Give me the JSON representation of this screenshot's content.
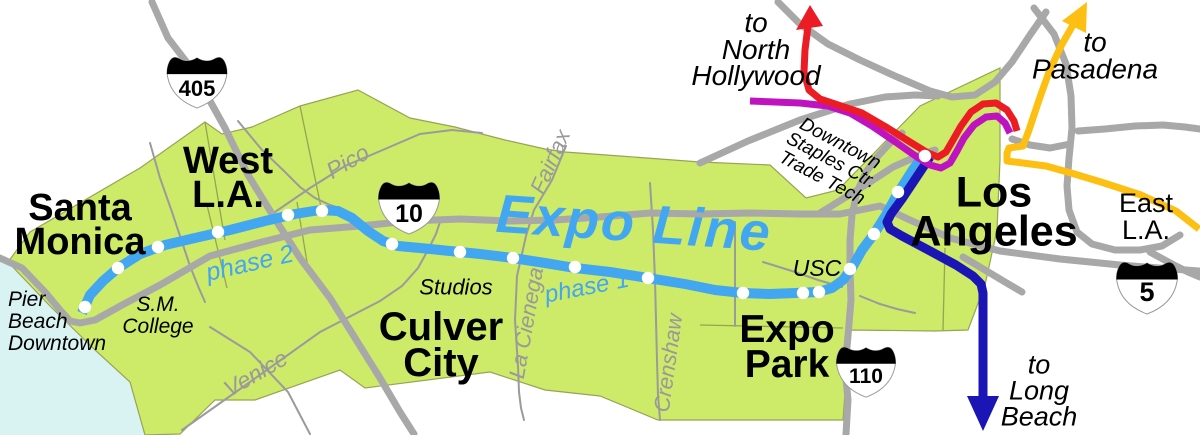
{
  "route": {
    "name": "Expo Line",
    "phase1": "phase 1",
    "phase2": "phase 2"
  },
  "cities": {
    "santa_monica": "Santa\nMonica",
    "west_la": "West\nL.A.",
    "culver_city": "Culver\nCity",
    "expo_park": "Expo\nPark",
    "los_angeles": "Los\nAngeles",
    "east_la": "East\nL.A."
  },
  "destinations": {
    "north_hollywood": "to\nNorth\nHollywood",
    "pasadena": "to\nPasadena",
    "long_beach": "to\nLong\nBeach"
  },
  "places": {
    "pier": "Pier\nBeach\nDowntown",
    "sm_college": "S.M.\nCollege",
    "studios": "Studios",
    "usc": "USC",
    "downtown": "Downtown\nStaples Ctr.\nTrade Tech"
  },
  "streets": {
    "pico": "Pico",
    "venice": "Venice",
    "fairfax": "Fairfax",
    "la_cienega": "La Cienega",
    "crenshaw": "Crenshaw"
  },
  "highways": {
    "i405": "405",
    "i10": "10",
    "i110": "110",
    "i5": "5"
  },
  "stations": [
    [
      85,
      307
    ],
    [
      118,
      268
    ],
    [
      158,
      247
    ],
    [
      218,
      232
    ],
    [
      288,
      215
    ],
    [
      322,
      211
    ],
    [
      392,
      244
    ],
    [
      460,
      252
    ],
    [
      513,
      258
    ],
    [
      575,
      267
    ],
    [
      648,
      278
    ],
    [
      743,
      293
    ],
    [
      803,
      293
    ],
    [
      819,
      292
    ],
    [
      850,
      269
    ],
    [
      874,
      234
    ],
    [
      898,
      192
    ],
    [
      925,
      156
    ]
  ],
  "colors": {
    "expo_blue": "#42a6f1",
    "long_beach_blue": "#1a15b4",
    "red_line": "#ec1c24",
    "purple_line": "#c013c0",
    "gold_line": "#fcbf12",
    "land_green": "#cdea68",
    "water": "#d8f3f2",
    "road_gray": "#a8a8a8",
    "street_gray": "#9b9b9b",
    "label_gray": "#999999"
  }
}
